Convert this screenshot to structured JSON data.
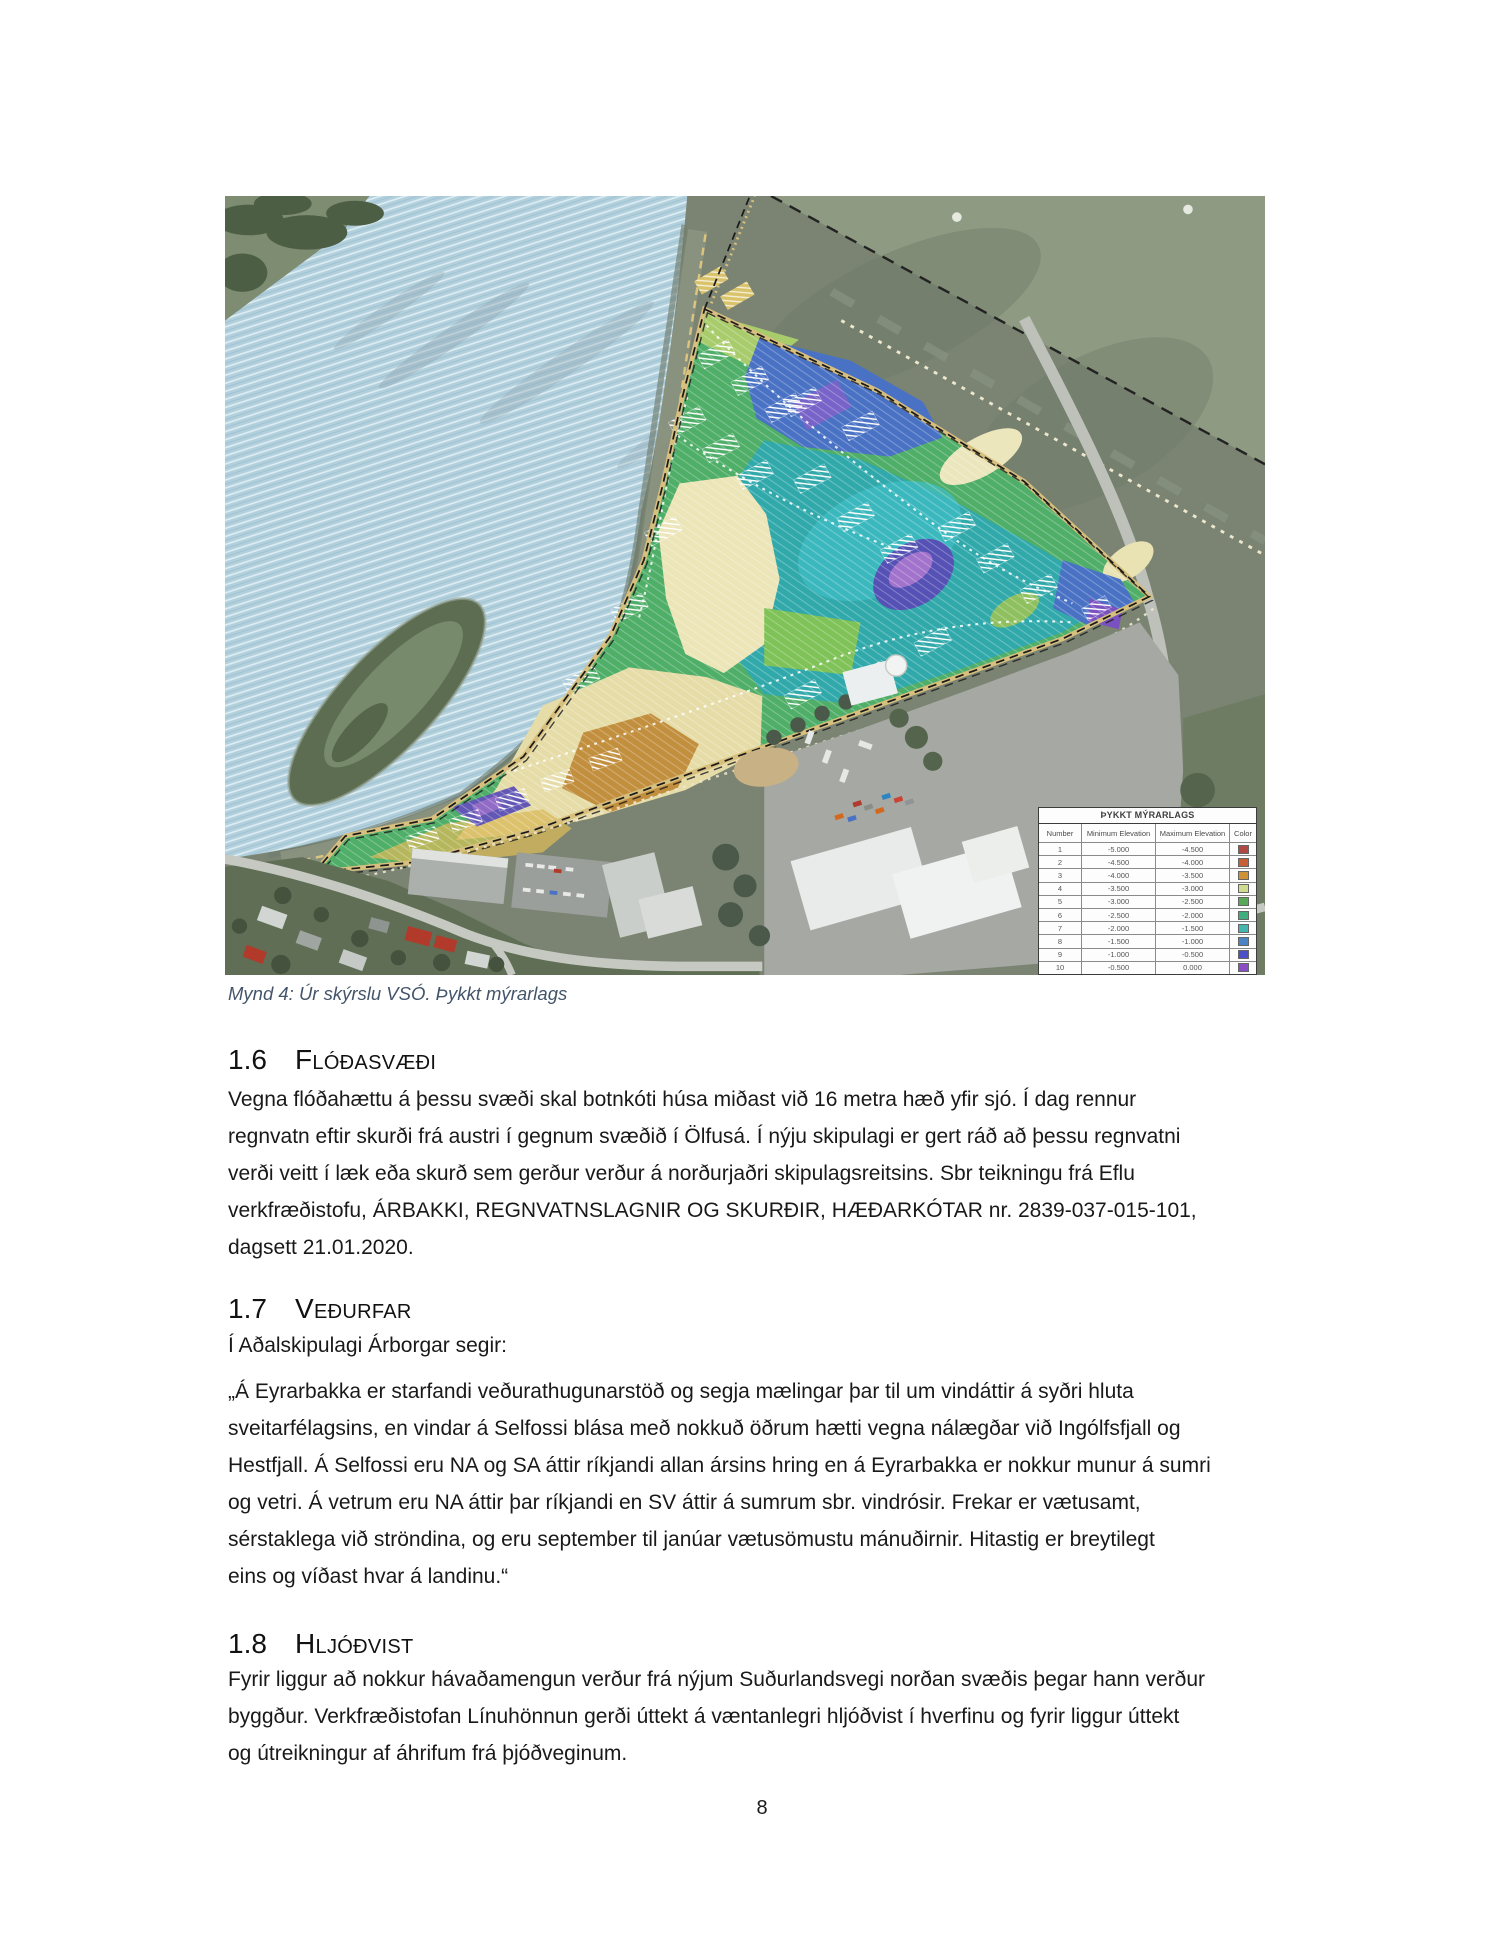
{
  "page": {
    "number": "8"
  },
  "figure": {
    "caption": "Mynd 4: Úr skýrslu VSÓ. Þykkt mýrarlags",
    "legend": {
      "title": "ÞYKKT MÝRARLAGS",
      "columns": {
        "number": "Number",
        "min": "Minimum Elevation",
        "max": "Maximum Elevation",
        "color": "Color"
      },
      "rows": [
        {
          "number": "1",
          "min": "-5.000",
          "max": "-4.500",
          "color": "#b04843"
        },
        {
          "number": "2",
          "min": "-4.500",
          "max": "-4.000",
          "color": "#c65f35"
        },
        {
          "number": "3",
          "min": "-4.000",
          "max": "-3.500",
          "color": "#cf9136"
        },
        {
          "number": "4",
          "min": "-3.500",
          "max": "-3.000",
          "color": "#cfdc8f"
        },
        {
          "number": "5",
          "min": "-3.000",
          "max": "-2.500",
          "color": "#57a857"
        },
        {
          "number": "6",
          "min": "-2.500",
          "max": "-2.000",
          "color": "#3fae7c"
        },
        {
          "number": "7",
          "min": "-2.000",
          "max": "-1.500",
          "color": "#45b5ad"
        },
        {
          "number": "8",
          "min": "-1.500",
          "max": "-1.000",
          "color": "#4a84c4"
        },
        {
          "number": "9",
          "min": "-1.000",
          "max": "-0.500",
          "color": "#4b4fc8"
        },
        {
          "number": "10",
          "min": "-0.500",
          "max": "0.000",
          "color": "#8a4ec4"
        }
      ]
    }
  },
  "sections": [
    {
      "number": "1.6",
      "title": "Flóðasvæði",
      "lines": [
        "Vegna flóðahættu á þessu svæði skal botnkóti húsa miðast við 16 metra hæð yfir sjó. Í dag rennur",
        "regnvatn eftir skurði frá austri í gegnum svæðið í Ölfusá. Í nýju skipulagi er gert ráð að þessu regnvatni",
        "verði veitt í læk eða skurð sem gerður verður á norðurjaðri skipulagsreitsins. Sbr teikningu frá Eflu",
        "verkfræðistofu, ÁRBAKKI, REGNVATNSLAGNIR OG SKURÐIR, HÆÐARKÓTAR nr. 2839-037-015-101,",
        "dagsett 21.01.2020."
      ]
    },
    {
      "number": "1.7",
      "title": "Veðurfar",
      "intro": "Í Aðalskipulagi Árborgar segir:",
      "lines": [
        "„Á Eyrarbakka er starfandi veðurathugunarstöð og segja mælingar þar til um vindáttir á syðri hluta",
        "sveitarfélagsins, en vindar á Selfossi blása með nokkuð öðrum hætti vegna nálægðar við Ingólfsfjall og",
        "Hestfjall. Á Selfossi eru NA og SA áttir ríkjandi allan ársins hring en á Eyrarbakka er nokkur munur á sumri",
        "og vetri. Á vetrum eru NA áttir þar ríkjandi en SV áttir á sumrum sbr. vindrósir. Frekar er vætusamt,",
        "sérstaklega við ströndina, og eru september til janúar vætusömustu mánuðirnir. Hitastig er breytilegt",
        "eins og víðast hvar á landinu.“"
      ]
    },
    {
      "number": "1.8",
      "title": "Hljóðvist",
      "lines": [
        "Fyrir liggur að nokkur hávaðamengun verður frá nýjum Suðurlandsvegi norðan svæðis þegar hann verður",
        "byggður. Verkfræðistofan Línuhönnun gerði úttekt á væntanlegri hljóðvist í hverfinu og fyrir liggur úttekt",
        "og útreikningur af áhrifum frá þjóðveginum."
      ]
    }
  ]
}
